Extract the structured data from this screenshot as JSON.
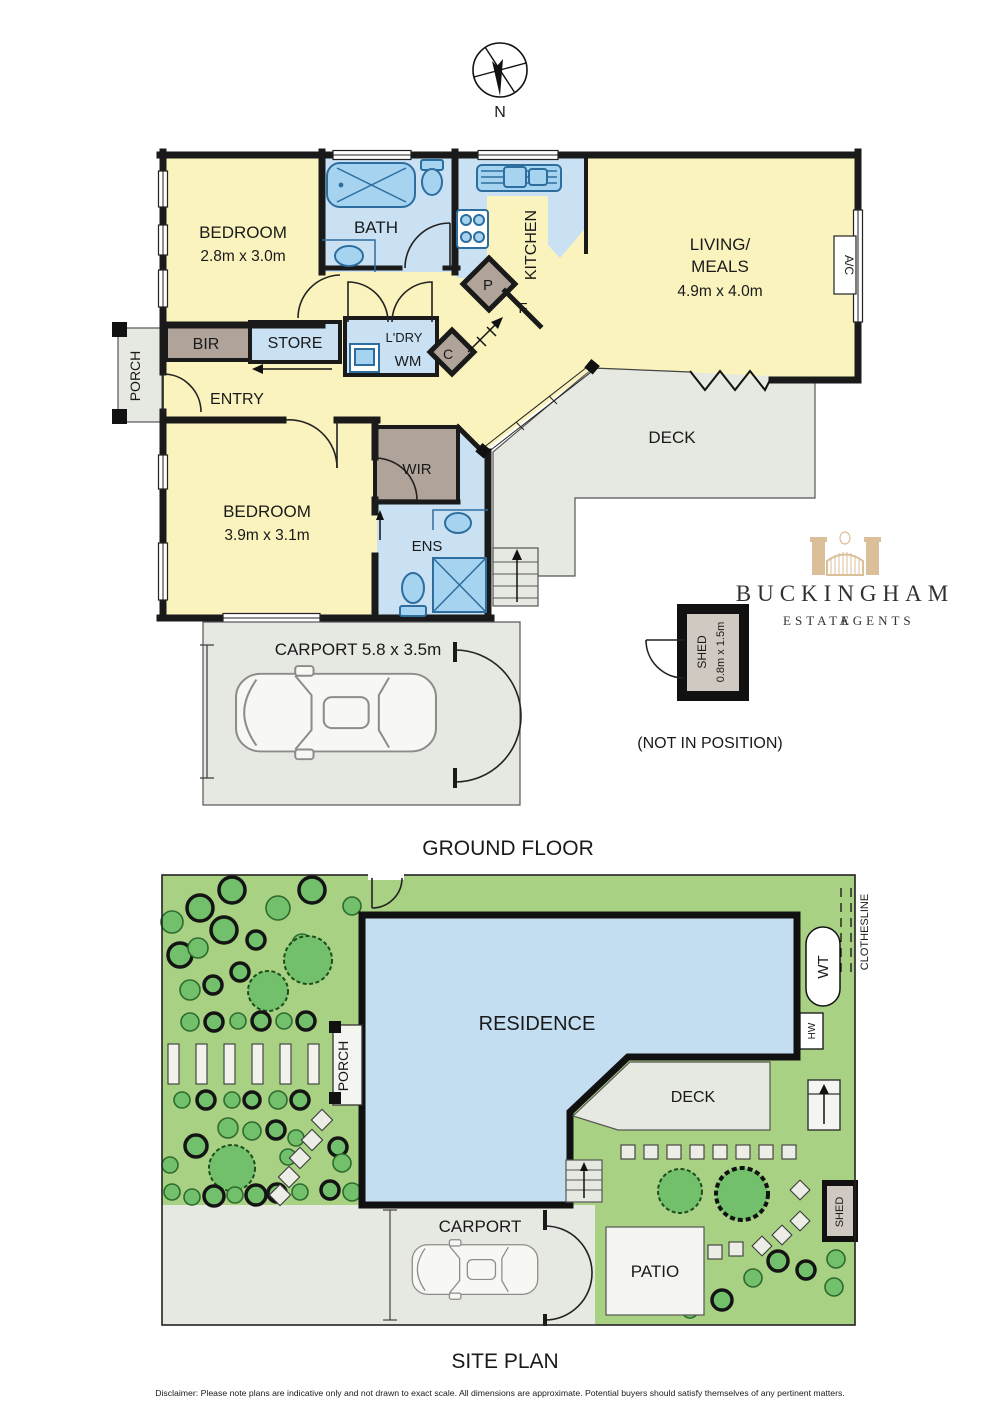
{
  "colors": {
    "room_yellow": "#FAF3BE",
    "wet_blue": "#C9E1F3",
    "fixture_blue": "#A6D3F0",
    "fixture_stroke": "#2D6E9E",
    "robe_brown": "#B0A39A",
    "paving_gray": "#E6E8E2",
    "wall_black": "#1A1A1A",
    "site_green": "#A9D183",
    "tree_green": "#72C06B",
    "residence_blue": "#C3DDF1",
    "logo_tan": "#D8B98E"
  },
  "compass": {
    "north": "N"
  },
  "titles": {
    "ground_floor": "GROUND FLOOR",
    "site_plan": "SITE PLAN",
    "not_in_position": "(NOT IN POSITION)",
    "disclaimer": "Disclaimer: Please note plans are indicative only and not drawn to exact scale. All dimensions are approximate. Potential buyers should satisfy themselves of any pertinent matters."
  },
  "ground_floor": {
    "bedroom1": {
      "name": "BEDROOM",
      "dims": "2.8m x 3.0m"
    },
    "bath": "BATH",
    "kitchen": "KITCHEN",
    "living": {
      "l1": "LIVING/",
      "l2": "MEALS",
      "dims": "4.9m x 4.0m"
    },
    "ac": "A/C",
    "bir": "BIR",
    "store": "STORE",
    "ldry": "L'DRY",
    "wm": "WM",
    "cupboard": "C",
    "pantry": "P",
    "fridge": "F",
    "entry": "ENTRY",
    "porch": "PORCH",
    "deck": "DECK",
    "bedroom2": {
      "name": "BEDROOM",
      "dims": "3.9m x 3.1m"
    },
    "wir": "WIR",
    "ens": "ENS",
    "carport": "CARPORT 5.8 x 3.5m",
    "shed": {
      "name": "SHED",
      "dims": "0.8m x 1.5m"
    }
  },
  "site_plan": {
    "residence": "RESIDENCE",
    "porch": "PORCH",
    "deck": "DECK",
    "carport": "CARPORT",
    "patio": "PATIO",
    "shed": "SHED",
    "wt": "WT",
    "hw": "HW",
    "clothesline": "CLOTHESLINE"
  },
  "branding": {
    "name": "BUCKINGHAM",
    "estate": "ESTATE",
    "agents": "AGENTS"
  }
}
